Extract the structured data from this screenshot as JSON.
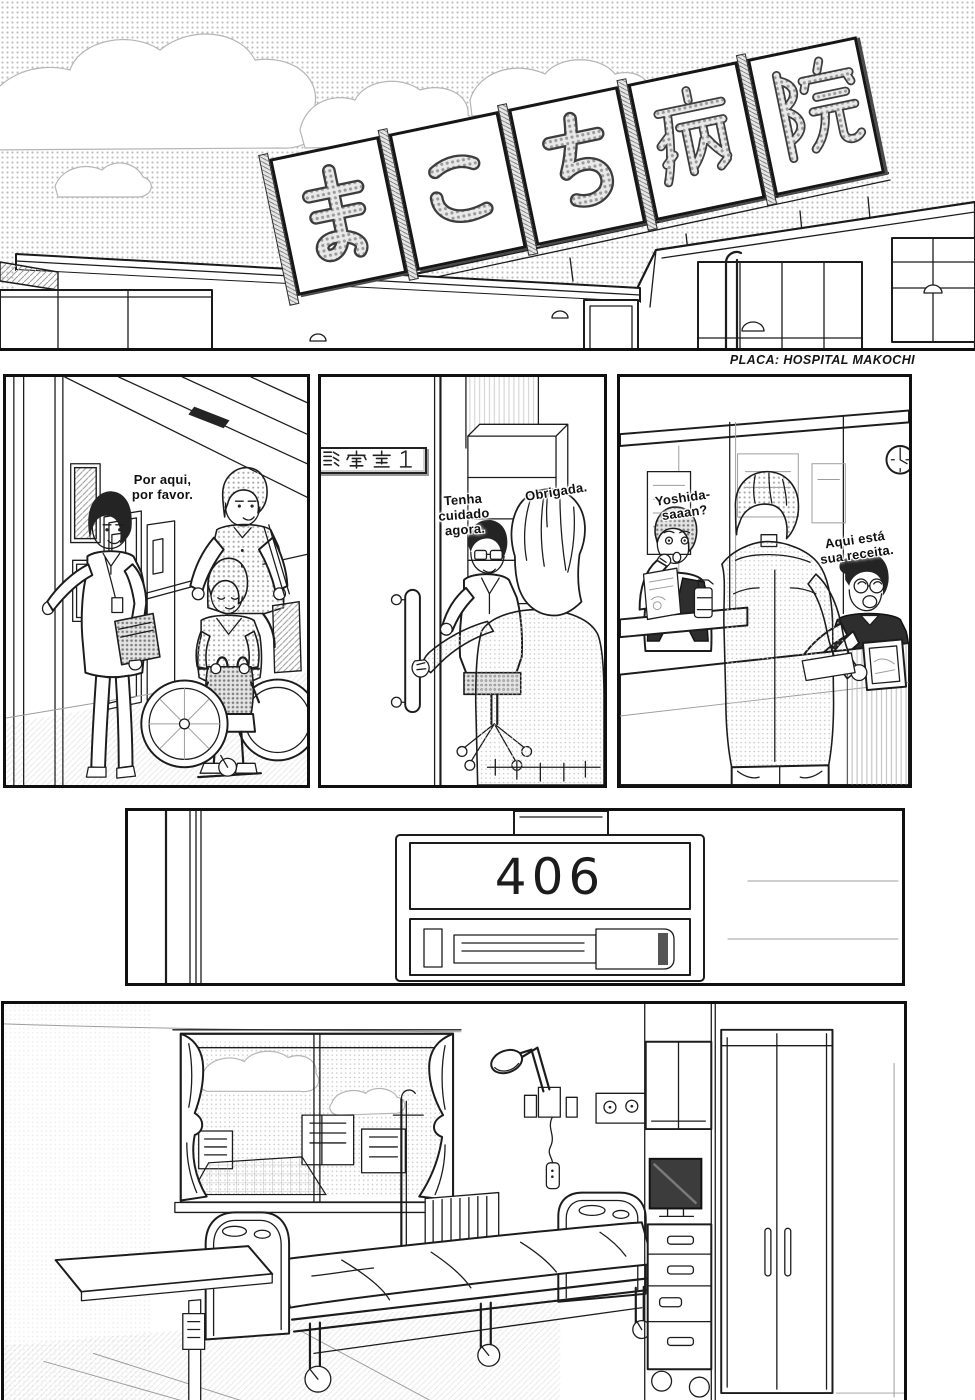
{
  "colors": {
    "ink": "#1a1a1a",
    "paper": "#ffffff",
    "tone_gray": "#a8a8a8"
  },
  "top_panel": {
    "caption": "PLACA: HOSPITAL MAKOCHI",
    "sign_text": "まこち病院",
    "sign_chars": [
      "ま",
      "こ",
      "ち",
      "病",
      "院"
    ]
  },
  "corridor_panel": {
    "nurse_dialogue_lines": [
      "Por aqui,",
      "por favor."
    ]
  },
  "exam_room_panel": {
    "door_plate": "診察室1",
    "doctor_dialogue_lines": [
      "Tenha",
      "cuidado",
      "agora."
    ],
    "patient_dialogue": "Obrigada."
  },
  "reception_panel": {
    "call_lines": [
      "Yoshida-",
      "saaan?"
    ],
    "receptionist_dialogue_lines": [
      "Aqui está",
      "sua receita."
    ]
  },
  "room_sign_panel": {
    "room_number": "406"
  }
}
